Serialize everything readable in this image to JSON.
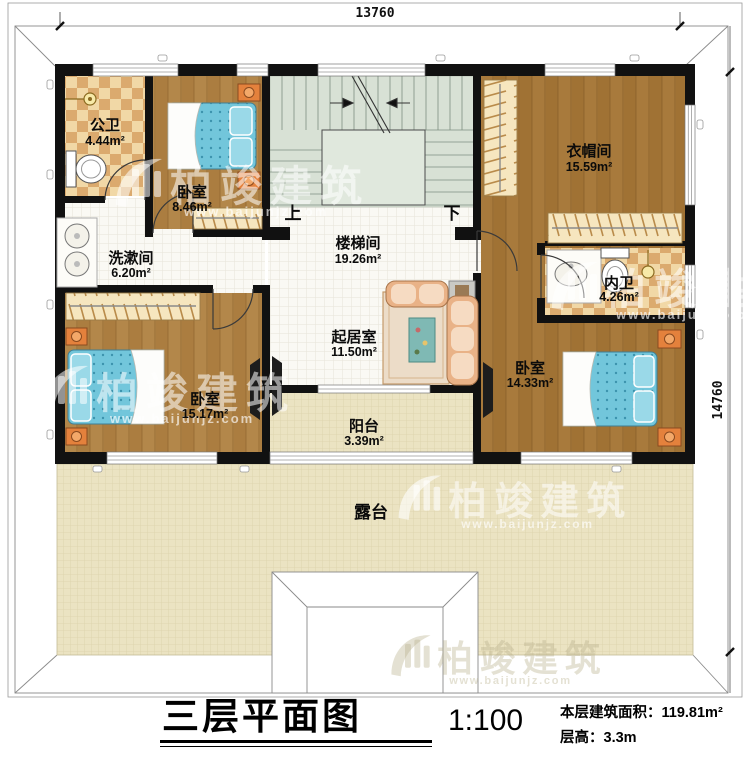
{
  "drawing": {
    "dimensions": {
      "width_mm": "13760",
      "height_mm": "14760"
    },
    "rooms": [
      {
        "name": "公卫",
        "area": "4.44m²"
      },
      {
        "name": "卧室",
        "area": "8.46m²"
      },
      {
        "name": "楼梯间",
        "area": "19.26m²"
      },
      {
        "name": "衣帽间",
        "area": "15.59m²"
      },
      {
        "name": "洗漱间",
        "area": "6.20m²"
      },
      {
        "name": "内卫",
        "area": "4.26m²"
      },
      {
        "name": "起居室",
        "area": "11.50m²"
      },
      {
        "name": "卧室",
        "area": "15.17m²"
      },
      {
        "name": "卧室",
        "area": "14.33m²"
      },
      {
        "name": "阳台",
        "area": "3.39m²"
      },
      {
        "name": "露台",
        "area": ""
      }
    ],
    "stairs": {
      "up": "上",
      "down": "下"
    }
  },
  "watermark": {
    "brand": "柏竣建筑",
    "url": "www.baijunjz.com"
  },
  "title_block": {
    "title": "三层平面图",
    "scale": "1:100",
    "area_label": "本层建筑面积：",
    "area_value": "119.81m²",
    "floor_height_label": "层高：",
    "floor_height_value": "3.3m"
  },
  "colors": {
    "wall": "#111111",
    "wood_floor": "#b3874a",
    "wood_floor_dark": "#a87a3c",
    "tile_checker_light": "#f1d8a6",
    "tile_checker_dark": "#dbaa6e",
    "stair_green": "#d8e1d5",
    "terrace_tan": "#ebe3c2",
    "bed_blue": "#72c6db",
    "nightstand_orange": "#e4813c",
    "sofa_peach": "#e9b287"
  }
}
